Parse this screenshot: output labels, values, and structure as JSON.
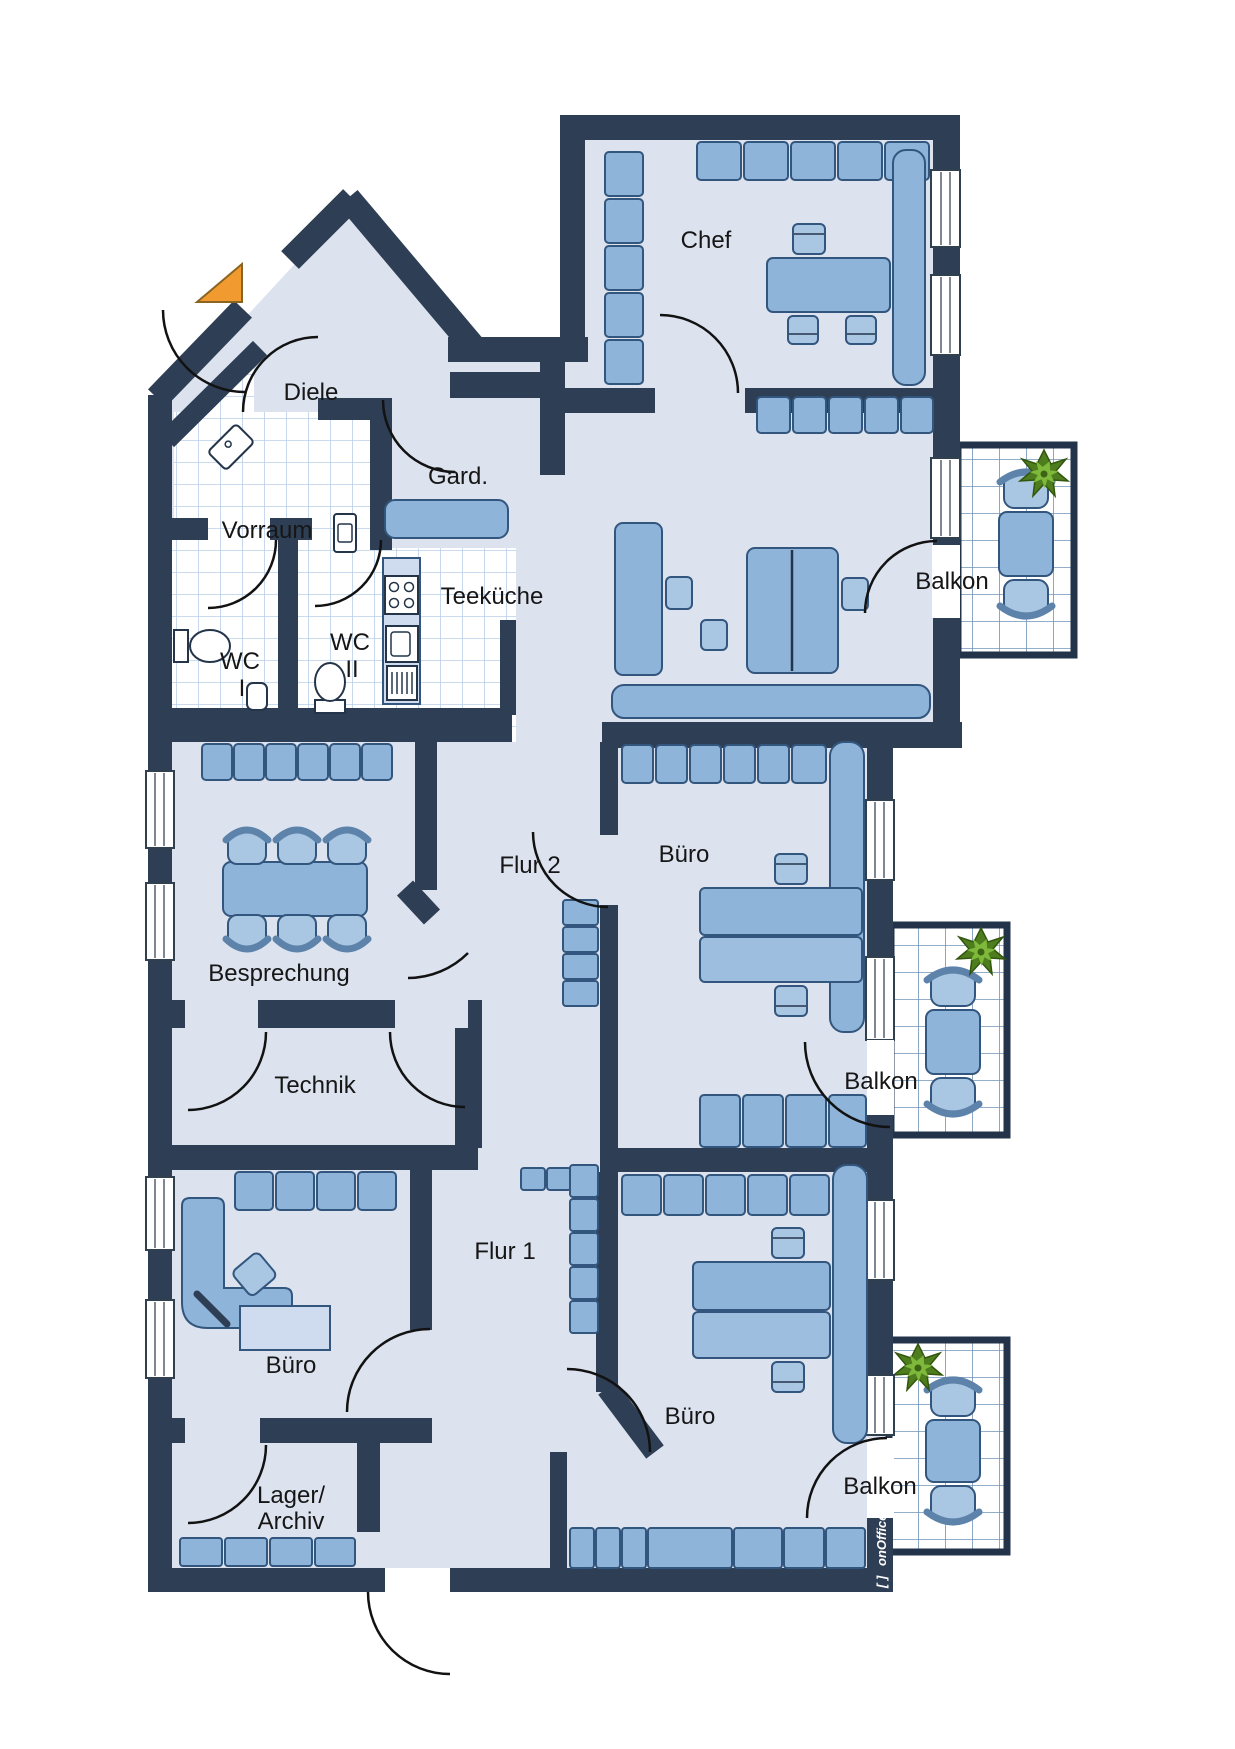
{
  "plan": {
    "rooms": {
      "chef": "Chef",
      "diele": "Diele",
      "garderobe": "Gard.",
      "vorraum": "Vorraum",
      "teekueche": "Teeküche",
      "wc1": [
        "WC",
        "I"
      ],
      "wc2": [
        "WC",
        "II"
      ],
      "besprechung": "Besprechung",
      "flur2": "Flur 2",
      "technik": "Technik",
      "flur1": "Flur 1",
      "buero_links": "Büro",
      "buero_mitte": "Büro",
      "buero_rechts": "Büro",
      "lager": [
        "Lager/",
        "Archiv"
      ],
      "balkon_oben": "Balkon",
      "balkon_mitte": "Balkon",
      "balkon_unten": "Balkon"
    },
    "branding": {
      "mark": "[ ]",
      "name": "onOffice"
    },
    "colors": {
      "wall": "#2e3e54",
      "floor": "#dce3ef",
      "furniture": "#8fb4d9",
      "furniture_light": "#a9c6e3",
      "tile_line": "#b9cfe9",
      "balcony_tile_line": "#6e93b8",
      "plant_green": "#4e7d1e",
      "entrance_marker_orange": "#f09a30"
    },
    "icons": {
      "entrance_marker": "orange-triangle",
      "plant": "potted-plant-top-view",
      "kitchen": [
        "stove-icon",
        "sink-icon",
        "dishwasher-icon"
      ],
      "sanitary": [
        "toilet-icon",
        "corner-sink-icon",
        "washbasin-icon",
        "urinal-icon"
      ]
    }
  }
}
